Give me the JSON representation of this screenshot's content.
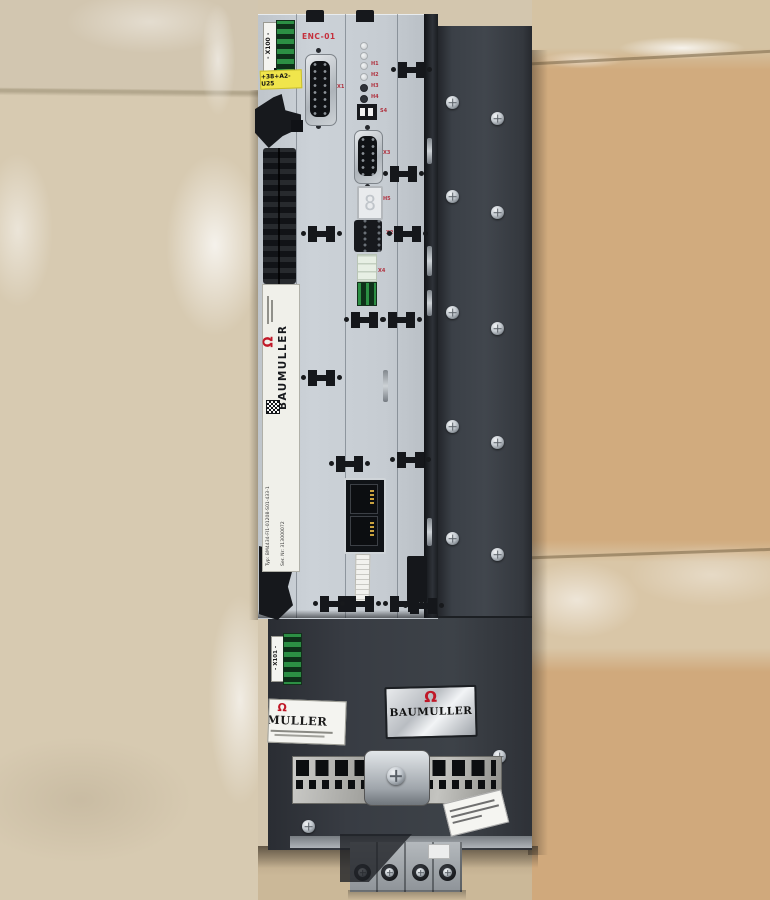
{
  "scene": {
    "caption": "Baumüller BM4434 servo drive module lying on a tiled workshop floor"
  },
  "colors": {
    "brand_red": "#c01828",
    "housing_dark": "#383c43",
    "faceplate_silver": "#c9ced4",
    "terminal_green": "#2c8f44",
    "tag_yellow": "#f0e54c",
    "floor_beige": "#d7cab1",
    "floor_tan": "#d1ab7e"
  },
  "icons": {
    "brand_logo_glyph": "Ω"
  },
  "device": {
    "x100": {
      "label": "- X100 -",
      "tag": "+38+A2-U25"
    },
    "enc": {
      "title": "ENC-01",
      "x1": "X1",
      "leds": [
        "H1",
        "H2",
        "H3",
        "H4"
      ],
      "s4": "S4",
      "x3": "X3",
      "h5": "H5",
      "display": "8",
      "x2": "X2",
      "x4": "X4"
    },
    "side_plate": {
      "brand": "BAUMULLER",
      "typ": "Typ: BM4434-FI1-01208-S01-433-1",
      "ser": "Ser. Nr: 313000072"
    },
    "x101": {
      "label": "- X101 -"
    },
    "brand_plate": {
      "brand": "BAUMULLER"
    },
    "partial_plate": {
      "brand": "MULLER"
    }
  }
}
